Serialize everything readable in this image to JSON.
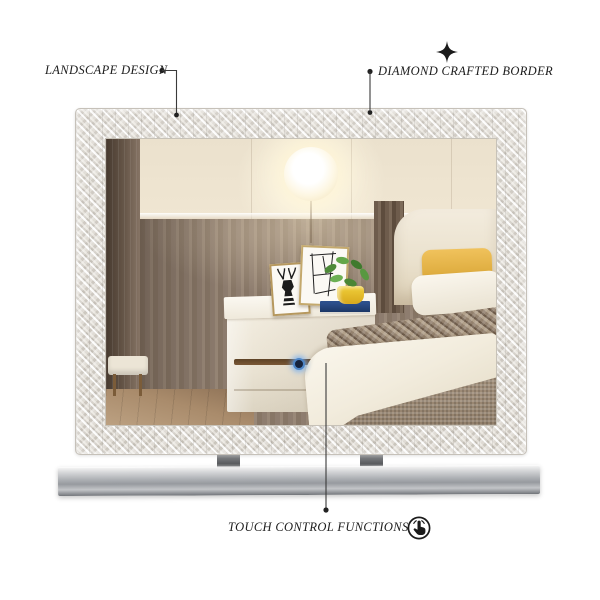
{
  "annotations": {
    "landscape_design": {
      "label": "LANDSCAPE DESIGN"
    },
    "diamond_border": {
      "label": "DIAMOND CRAFTED BORDER",
      "icon": "sparkle-icon"
    },
    "touch_control": {
      "label": "TOUCH CONTROL FUNCTIONS",
      "icon": "touch-gesture-icon"
    }
  },
  "icons": {
    "sparkle": {
      "name": "sparkle-icon",
      "glyph": "✦"
    },
    "touch": {
      "name": "touch-gesture-icon",
      "glyph": "hand-tap inside circle"
    }
  },
  "colors": {
    "background": "#ffffff",
    "annotation_ink": "#1d1d1d",
    "frame_crystal_silver": "#e7e4df",
    "touch_button_ring": "#4f86c6",
    "touch_button_core": "#16233c",
    "base_chrome": "#aab0b5",
    "pendant_light_glow": "#fff4d4",
    "pillow_yellow": "#e5b446",
    "plant_pot_yellow": "#e4bc2a",
    "book_navy": "#1c3766"
  }
}
